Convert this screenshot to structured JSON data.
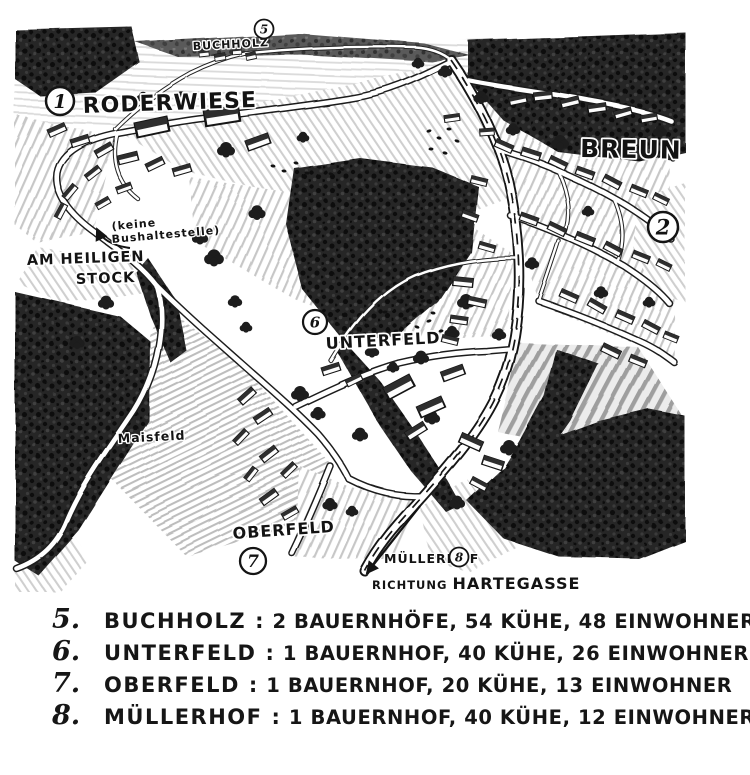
{
  "map": {
    "markers": {
      "roderwiese": "1",
      "breun": "2",
      "buchholz": "5",
      "unterfeld": "6",
      "oberfeld": "7",
      "muellerhof": "8"
    },
    "labels": {
      "roderwiese": "RODERWIESE",
      "buchholz": "BUCHHOLZ",
      "breun": "BREUN",
      "keine_bushaltestelle_line1": "(keine",
      "keine_bushaltestelle_line2": "Bushaltestelle)",
      "am_heiligen_line1": "AM HEILIGEN",
      "am_heiligen_line2": "STOCK",
      "unterfeld": "UNTERFELD",
      "maisfeld": "Maisfeld",
      "oberfeld": "OBERFELD",
      "muellerhof": "MÜLLERHOF",
      "richtung": "RICHTUNG ",
      "hartegasse": "HARTEGASSE"
    }
  },
  "legend": {
    "separator": ":",
    "entries": [
      {
        "number": "5.",
        "name": "BUCHHOLZ",
        "details": "2 BAUERNHÖFE, 54 KÜHE, 48 EINWOHNER"
      },
      {
        "number": "6.",
        "name": "UNTERFELD",
        "details": "1 BAUERNHOF, 40 KÜHE, 26 EINWOHNER"
      },
      {
        "number": "7.",
        "name": "OBERFELD",
        "details": "1 BAUERNHOF, 20 KÜHE, 13 EINWOHNER"
      },
      {
        "number": "8.",
        "name": "MÜLLERHOF",
        "details": "1 BAUERNHOF, 40 KÜHE, 12 EINWOHNER"
      }
    ]
  },
  "colors": {
    "ink": "#161616",
    "paper": "#ffffff"
  }
}
